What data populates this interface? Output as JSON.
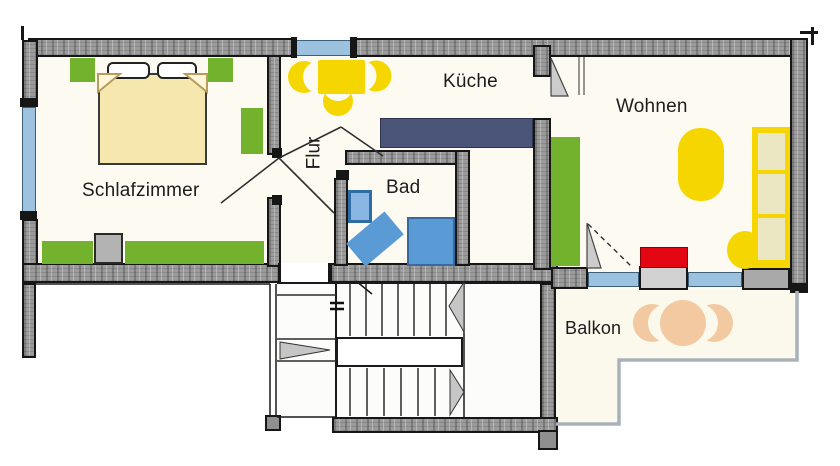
{
  "floorplan": {
    "type": "apartment-floor-plan",
    "rooms": [
      {
        "id": "schlafzimmer",
        "label": "Schlafzimmer"
      },
      {
        "id": "flur",
        "label": "Flur"
      },
      {
        "id": "kueche",
        "label": "Küche"
      },
      {
        "id": "bad",
        "label": "Bad"
      },
      {
        "id": "wohnen",
        "label": "Wohnen"
      },
      {
        "id": "balkon",
        "label": "Balkon"
      }
    ],
    "colors": {
      "wall": "#9b9b9b",
      "wall_outline": "#161616",
      "window": "#9cc2e0",
      "room_floor": "#fdfbf1",
      "balcony_floor": "#fbf8ec",
      "furniture_green": "#72b22c",
      "furniture_yellow": "#f6d600",
      "sofa_cushion": "#ece7c3",
      "bed": "#f6e7ae",
      "counter": "#4b5479",
      "bath_fixture": "#5b9bd5",
      "bath_fixture_dark": "#2e6da4",
      "tv_red": "#e30613",
      "balcony_furniture": "#f3c9a2",
      "railing": "#a9b2ba",
      "stair_arrow": "#c6c6c6",
      "door_leaf": "#cccccc"
    }
  }
}
